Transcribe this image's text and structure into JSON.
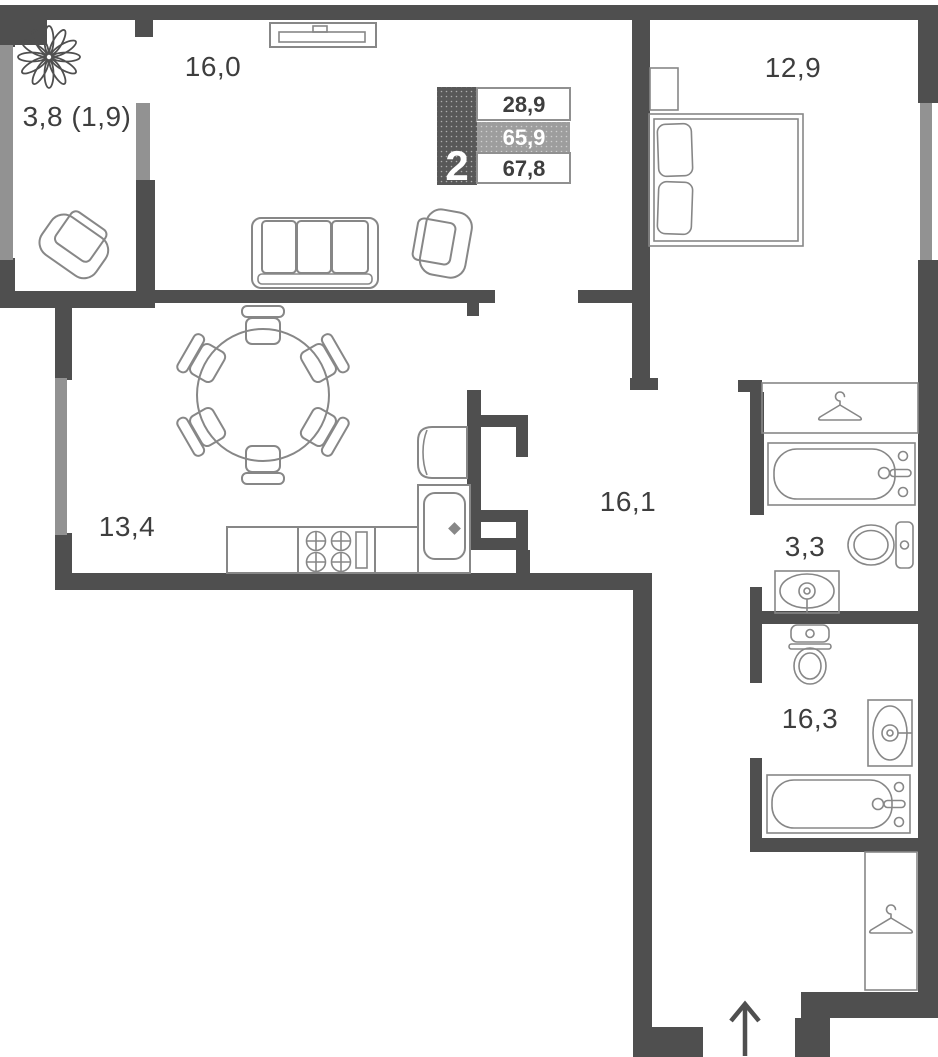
{
  "title": "2-room apartment floor plan",
  "legend": {
    "rooms_count": "2",
    "living_area": "28,9",
    "apartment_area": "65,9",
    "total_area": "67,8"
  },
  "rooms": [
    {
      "name": "loggia",
      "area_label": "3,8 (1,9)"
    },
    {
      "name": "living-room",
      "area_label": "16,0"
    },
    {
      "name": "bedroom",
      "area_label": "12,9"
    },
    {
      "name": "kitchen-dining",
      "area_label": "13,4"
    },
    {
      "name": "hallway",
      "area_label": "16,1"
    },
    {
      "name": "bathroom",
      "area_label": "3,3"
    },
    {
      "name": "shower-room",
      "area_label": "16,3"
    }
  ],
  "icons": [
    "plant-icon",
    "hanger-icon",
    "entrance-arrow-icon"
  ],
  "colors": {
    "wall-color": "#4f4f4f",
    "window-color": "#929292",
    "furniture-color": "#878787",
    "label-color": "#3e3e3e",
    "legend-dark": "#585858",
    "legend-mid": "#9d9d9d",
    "legend-border": "#909090",
    "bg-color": "#ffffff"
  }
}
